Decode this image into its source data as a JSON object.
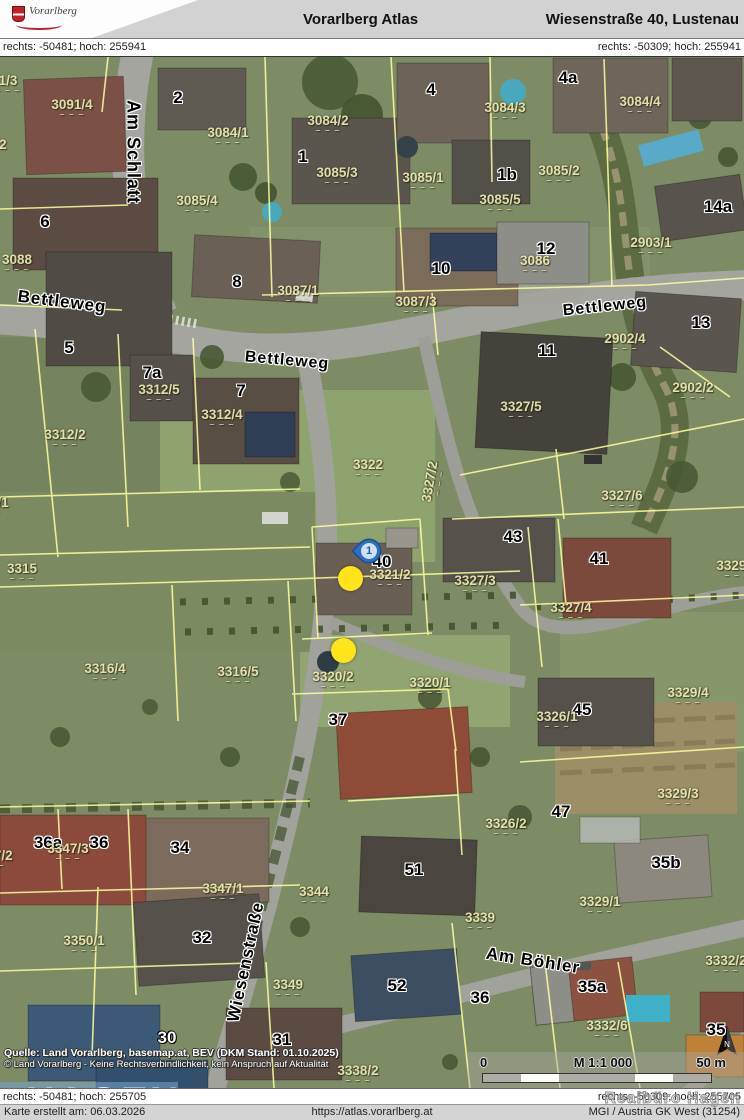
{
  "header": {
    "app_title": "Vorarlberg Atlas",
    "location_title": "Wiesenstraße 40, Lustenau",
    "logo_text": "Vorarlberg"
  },
  "coords": {
    "top_left": "rechts: -50481; hoch: 255941",
    "top_right": "rechts: -50309; hoch: 255941",
    "bottom_left": "rechts: -50481; hoch: 255705",
    "bottom_right": "rechts: -50309; hoch: 255705"
  },
  "footer": {
    "created": "Karte erstellt am: 06.03.2026",
    "url": "https://atlas.vorarlberg.at",
    "crs": "MGI / Austria GK West (31254)",
    "watermark": "Realbüro Hagen"
  },
  "map": {
    "attribution_line1": "Quelle: Land Vorarlberg, basemap.at, BEV (DKM Stand: 01.10.2025)",
    "attribution_line2": "© Land Vorarlberg - Keine Rechtsverbindlichkeit, kein Anspruch auf Aktualität",
    "scale": {
      "zero": "0",
      "ratio": "M 1:1 000",
      "distance": "50 m"
    },
    "logo_overlay": {
      "title": "HAGEN",
      "subtitle": "REALBÜRO"
    },
    "marker": {
      "label": "1"
    },
    "street_labels": [
      {
        "t": "Am Schlatt",
        "x": 133,
        "y": 95,
        "r": 90,
        "s": 18
      },
      {
        "t": "Bettleweg",
        "x": 62,
        "y": 245,
        "r": 7,
        "s": 17
      },
      {
        "t": "Bettleweg",
        "x": 287,
        "y": 304,
        "r": 5,
        "s": 16
      },
      {
        "t": "Bettleweg",
        "x": 605,
        "y": 250,
        "r": -6,
        "s": 16
      },
      {
        "t": "Wiesenstraße",
        "x": 246,
        "y": 905,
        "r": -78,
        "s": 17
      },
      {
        "t": "Am Böhler",
        "x": 533,
        "y": 904,
        "r": 9,
        "s": 17
      }
    ],
    "house_numbers": [
      {
        "t": "2",
        "x": 178,
        "y": 41
      },
      {
        "t": "4",
        "x": 431,
        "y": 33
      },
      {
        "t": "4a",
        "x": 568,
        "y": 21
      },
      {
        "t": "1",
        "x": 303,
        "y": 100
      },
      {
        "t": "1b",
        "x": 507,
        "y": 118
      },
      {
        "t": "6",
        "x": 45,
        "y": 165
      },
      {
        "t": "8",
        "x": 237,
        "y": 225
      },
      {
        "t": "10",
        "x": 441,
        "y": 212
      },
      {
        "t": "12",
        "x": 546,
        "y": 192
      },
      {
        "t": "14a",
        "x": 718,
        "y": 150
      },
      {
        "t": "13",
        "x": 701,
        "y": 266
      },
      {
        "t": "11",
        "x": 547,
        "y": 294
      },
      {
        "t": "5",
        "x": 69,
        "y": 291
      },
      {
        "t": "7a",
        "x": 152,
        "y": 316
      },
      {
        "t": "7",
        "x": 241,
        "y": 334
      },
      {
        "t": "43",
        "x": 513,
        "y": 480
      },
      {
        "t": "41",
        "x": 599,
        "y": 502
      },
      {
        "t": "40",
        "x": 382,
        "y": 505
      },
      {
        "t": "37",
        "x": 338,
        "y": 663
      },
      {
        "t": "45",
        "x": 582,
        "y": 653
      },
      {
        "t": "47",
        "x": 561,
        "y": 755
      },
      {
        "t": "36a",
        "x": 48,
        "y": 786
      },
      {
        "t": "36",
        "x": 99,
        "y": 786
      },
      {
        "t": "34",
        "x": 180,
        "y": 791
      },
      {
        "t": "51",
        "x": 414,
        "y": 813
      },
      {
        "t": "35b",
        "x": 666,
        "y": 806
      },
      {
        "t": "32",
        "x": 202,
        "y": 881
      },
      {
        "t": "52",
        "x": 397,
        "y": 929
      },
      {
        "t": "31",
        "x": 282,
        "y": 983
      },
      {
        "t": "36",
        "x": 480,
        "y": 941
      },
      {
        "t": "35a",
        "x": 592,
        "y": 930
      },
      {
        "t": "35",
        "x": 716,
        "y": 973
      },
      {
        "t": "30",
        "x": 167,
        "y": 981,
        "inv": true
      }
    ],
    "parcel_labels": [
      {
        "t": "1/3",
        "x": 8,
        "y": 26
      },
      {
        "t": "3091/4",
        "x": 72,
        "y": 50
      },
      {
        "t": "3090/2",
        "x": -14,
        "y": 90
      },
      {
        "t": "3084/2",
        "x": 328,
        "y": 66
      },
      {
        "t": "3084/1",
        "x": 228,
        "y": 78
      },
      {
        "t": "3084/3",
        "x": 505,
        "y": 53
      },
      {
        "t": "3084/4",
        "x": 640,
        "y": 47
      },
      {
        "t": "3085/3",
        "x": 337,
        "y": 118
      },
      {
        "t": "3085/1",
        "x": 423,
        "y": 123
      },
      {
        "t": "3085/2",
        "x": 559,
        "y": 116
      },
      {
        "t": "3085/4",
        "x": 197,
        "y": 146
      },
      {
        "t": "3085/5",
        "x": 500,
        "y": 145
      },
      {
        "t": "3086",
        "x": 535,
        "y": 206
      },
      {
        "t": "3088",
        "x": 17,
        "y": 205
      },
      {
        "t": "3087/1",
        "x": 298,
        "y": 236
      },
      {
        "t": "3087/3",
        "x": 416,
        "y": 247
      },
      {
        "t": "2902/4",
        "x": 625,
        "y": 284
      },
      {
        "t": "2902/2",
        "x": 693,
        "y": 333
      },
      {
        "t": "2903/1",
        "x": 651,
        "y": 188
      },
      {
        "t": "3312/5",
        "x": 159,
        "y": 335
      },
      {
        "t": "3312/4",
        "x": 222,
        "y": 360
      },
      {
        "t": "3312/2",
        "x": 65,
        "y": 380
      },
      {
        "t": "3313/1",
        "x": -12,
        "y": 448
      },
      {
        "t": "3315",
        "x": 22,
        "y": 514
      },
      {
        "t": "3322",
        "x": 368,
        "y": 410
      },
      {
        "t": "3327/2",
        "x": 432,
        "y": 425,
        "r": -80
      },
      {
        "t": "3327/5",
        "x": 521,
        "y": 352
      },
      {
        "t": "3327/6",
        "x": 622,
        "y": 441
      },
      {
        "t": "3327/3",
        "x": 475,
        "y": 526
      },
      {
        "t": "3321/2",
        "x": 390,
        "y": 520
      },
      {
        "t": "3327/4",
        "x": 571,
        "y": 553
      },
      {
        "t": "3329/2",
        "x": 737,
        "y": 511
      },
      {
        "t": "3320/2",
        "x": 333,
        "y": 622
      },
      {
        "t": "3320/1",
        "x": 430,
        "y": 628
      },
      {
        "t": "3316/4",
        "x": 105,
        "y": 614
      },
      {
        "t": "3316/5",
        "x": 238,
        "y": 617
      },
      {
        "t": "3326/1",
        "x": 557,
        "y": 662
      },
      {
        "t": "3329/4",
        "x": 688,
        "y": 638
      },
      {
        "t": "3329/3",
        "x": 678,
        "y": 739
      },
      {
        "t": "3326/2",
        "x": 506,
        "y": 769
      },
      {
        "t": "3329/1",
        "x": 600,
        "y": 847
      },
      {
        "t": "3347/3",
        "x": 68,
        "y": 794
      },
      {
        "t": "3347/2",
        "x": -8,
        "y": 801
      },
      {
        "t": "3347/1",
        "x": 223,
        "y": 834
      },
      {
        "t": "3344",
        "x": 314,
        "y": 837
      },
      {
        "t": "3339",
        "x": 480,
        "y": 863
      },
      {
        "t": "3350/1",
        "x": 84,
        "y": 886
      },
      {
        "t": "3349",
        "x": 288,
        "y": 930
      },
      {
        "t": "3338/2",
        "x": 358,
        "y": 1016
      },
      {
        "t": "3332/6",
        "x": 607,
        "y": 971
      },
      {
        "t": "3332/2",
        "x": 726,
        "y": 906
      }
    ]
  },
  "colors": {
    "accent_yellow": "#ffe41a",
    "pin_blue": "#2e6fc2",
    "overlay_blue": "#74a2ce",
    "parcel_line_yellow": "#ffffa0",
    "header_gray": "#d2d2d2"
  }
}
